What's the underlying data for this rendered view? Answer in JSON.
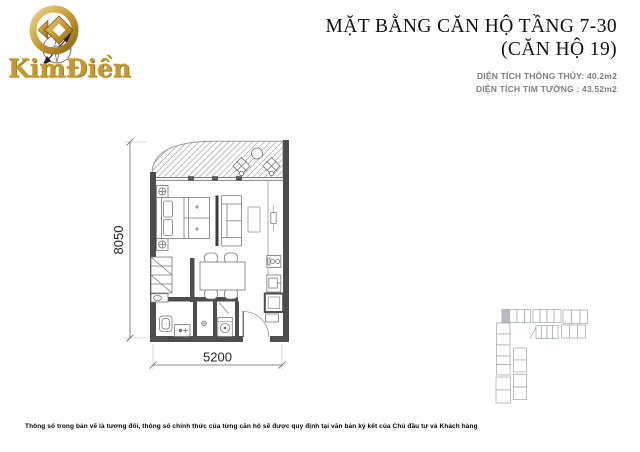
{
  "logo": {
    "brand": "KimĐiền"
  },
  "header": {
    "title_line1": "MẶT BẰNG CĂN HỘ TẦNG 7-30",
    "title_line2": "(CĂN HỘ 19)",
    "area_net": "DIỆN TÍCH THÔNG THỦY: 40.2m2",
    "area_gross": "DIỆN TÍCH TIM TƯỜNG : 43.52m2"
  },
  "plan": {
    "dim_height_mm": "8050",
    "dim_width_mm": "5200"
  },
  "keyplan": {
    "highlight_color": "#b7bac2"
  },
  "footer": {
    "disclaimer": "Thông số trong bản vẽ là tương đối, thông số chính thức của từng căn hộ sẽ được quy định tại văn bản ký kết của Chủ đầu tư và Khách hàng"
  },
  "colors": {
    "gold": "#c6992f",
    "wall": "#4d4d4d",
    "furniture_line": "#777777",
    "muted_text": "#7d7d7d",
    "title_text": "#101010",
    "keyplan_line": "#a0a4ab"
  }
}
